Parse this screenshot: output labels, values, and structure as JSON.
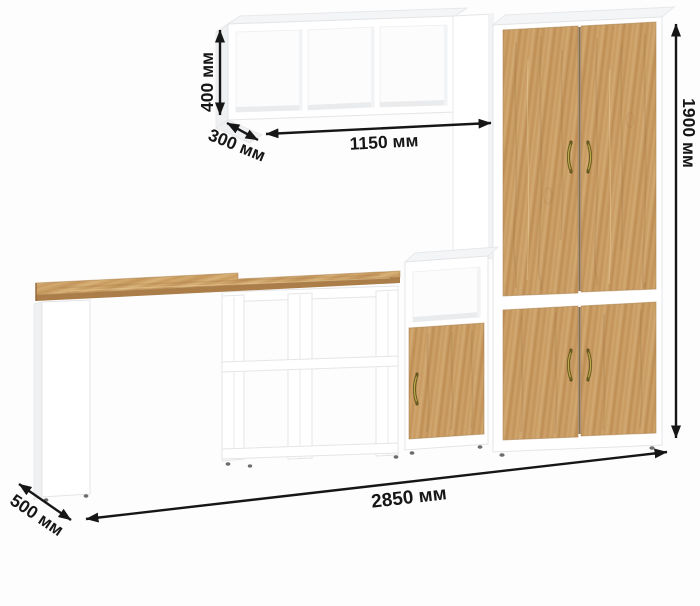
{
  "annotations": {
    "wall_shelf_height": "400 мм",
    "wall_shelf_depth": "300 мм",
    "wall_shelf_width": "1150 мм",
    "cabinet_height": "1900 мм",
    "total_width": "2850 мм",
    "desk_depth": "500 мм"
  },
  "colors": {
    "background": "#fdfdfe",
    "panel_white": "#ffffff",
    "panel_edge": "#e4e5e7",
    "wood_base": "#c79a60",
    "wood_light": "#d3aa74",
    "wood_dark": "#a97c46",
    "desk_edge_wood": "#ab7d48",
    "dimension_ink": "#161616",
    "handle_brass": "#8a7a30"
  }
}
